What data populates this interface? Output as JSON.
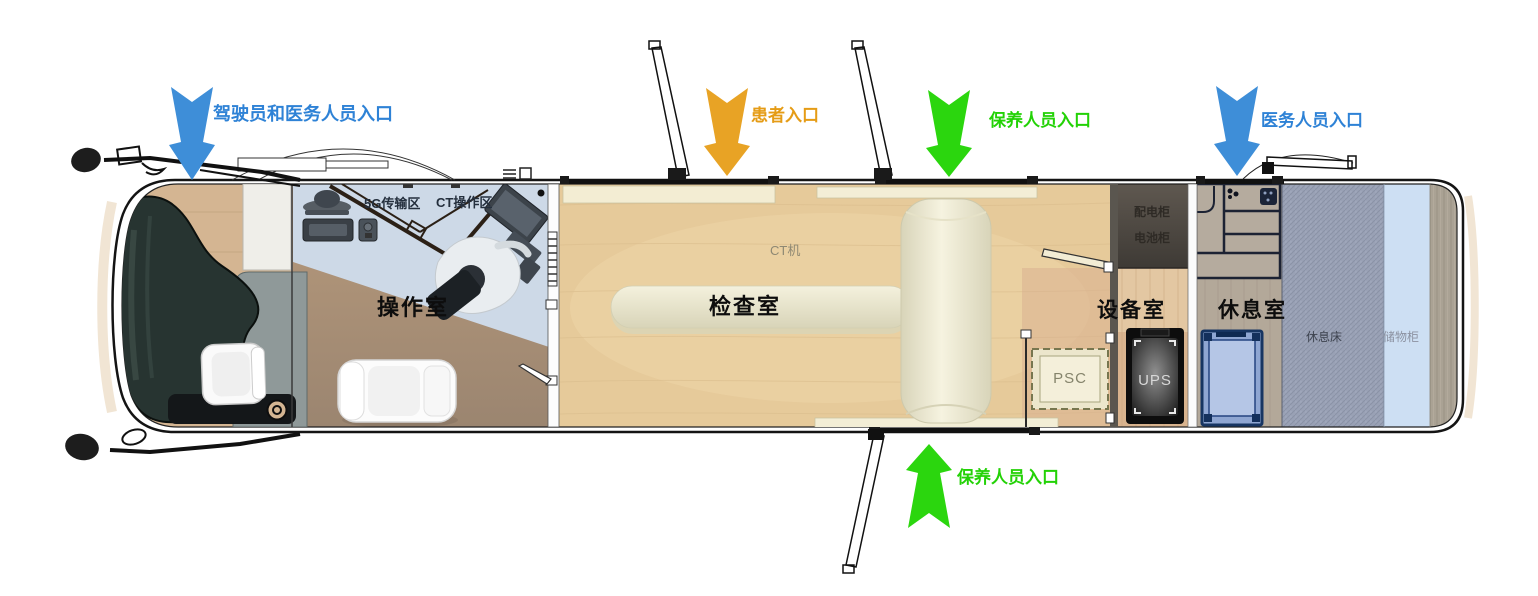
{
  "entrances": [
    {
      "id": "driver-and-medical",
      "label": "驾驶员和医务人员入口",
      "color": "#2E82D6",
      "arrow": "#3E8ED8",
      "direction": "down"
    },
    {
      "id": "patient",
      "label": "患者入口",
      "color": "#E59C16",
      "arrow": "#E8A325",
      "direction": "down"
    },
    {
      "id": "maintenance-top",
      "label": "保养人员入口",
      "color": "#23D206",
      "arrow": "#2BD60E",
      "direction": "down"
    },
    {
      "id": "medical",
      "label": "医务人员入口",
      "color": "#2E82D6",
      "arrow": "#3E8ED8",
      "direction": "down"
    },
    {
      "id": "maintenance-bottom",
      "label": "保养人员入口",
      "color": "#23D206",
      "arrow": "#2BD60E",
      "direction": "up"
    }
  ],
  "rooms": [
    {
      "id": "operation",
      "name": "操作室"
    },
    {
      "id": "examination",
      "name": "检查室"
    },
    {
      "id": "equipment",
      "name": "设备室"
    },
    {
      "id": "rest",
      "name": "休息室"
    }
  ],
  "zones": {
    "transmission_5g": "5G传输区",
    "ct_console": "CT操作区",
    "ct_machine": "CT机",
    "power_cabinet": "配电柜",
    "battery_cabinet": "电池柜",
    "psc": "PSC",
    "ups": "UPS",
    "rest_bed": "休息床",
    "storage_cabinet": "储物柜"
  },
  "colors": {
    "exam_floor": "#E6CA9A",
    "operation_floor_top": "#CDD9E7",
    "operation_floor_bottom": "#9C8570",
    "equipment_floor": "#D8B38E",
    "rest_floor": "#B3A899",
    "fabric_bed": "#99A1B5",
    "storage_column": "#CDDFF3",
    "ct_machine_body": "#EDEAD4",
    "cabinet_dark": "#4B4540",
    "cot_blue": "#8FA6D2"
  }
}
